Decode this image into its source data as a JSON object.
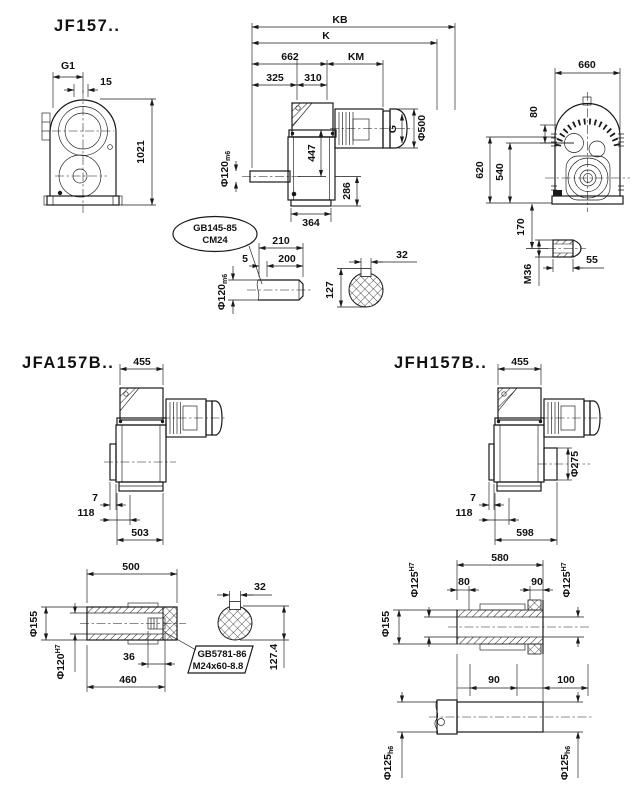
{
  "colors": {
    "line": "#1a1a1a",
    "bg": "#ffffff"
  },
  "jf157": {
    "title": "JF157..",
    "front": {
      "g1": "G1",
      "offset": "15",
      "height": "1021"
    },
    "side": {
      "kb": "KB",
      "k": "K",
      "l662": "662",
      "km": "KM",
      "l325": "325",
      "l310": "310",
      "h447": "447",
      "h286": "286",
      "w364": "364",
      "shaft_dia": "Φ120",
      "shaft_fit": "m6",
      "g": "G",
      "fan_dia": "Φ500"
    },
    "rear": {
      "w660": "660",
      "t80": "80",
      "h620": "620",
      "h540": "540",
      "h170": "170",
      "thread": "M36",
      "l55": "55"
    },
    "key_callout": {
      "line1": "GB145-85",
      "line2": "CM24"
    },
    "shaft_end": {
      "l210": "210",
      "l200": "200",
      "l5": "5",
      "dia": "Φ120",
      "fit": "m6",
      "h127": "127",
      "key_w": "32"
    }
  },
  "jfa157b": {
    "title": "JFA157B..",
    "w455": "455",
    "o7": "7",
    "o118": "118",
    "l503": "503"
  },
  "jfh157b": {
    "title": "JFH157B..",
    "w455": "455",
    "flange_dia": "Φ275",
    "o7": "7",
    "o118": "118",
    "l598": "598"
  },
  "hollow_shaft": {
    "l500": "500",
    "od": "Φ155",
    "bore": "Φ120",
    "bore_fit": "H7",
    "l36": "36",
    "l460": "460",
    "callout1": "GB5781-86",
    "callout2": "M24x60-8.8",
    "key_w": "32",
    "key_h": "127.4"
  },
  "jfh_hollow": {
    "l580": "580",
    "l80": "80",
    "l90": "90",
    "od": "Φ155",
    "bore_l": "Φ125",
    "bore_l_fit": "H7",
    "bore_r": "Φ125",
    "bore_r_fit": "H7"
  },
  "jfh_shaft": {
    "l90": "90",
    "l100": "100",
    "dia_l": "Φ125",
    "dia_l_fit": "h6",
    "dia_r": "Φ125",
    "dia_r_fit": "h6"
  }
}
